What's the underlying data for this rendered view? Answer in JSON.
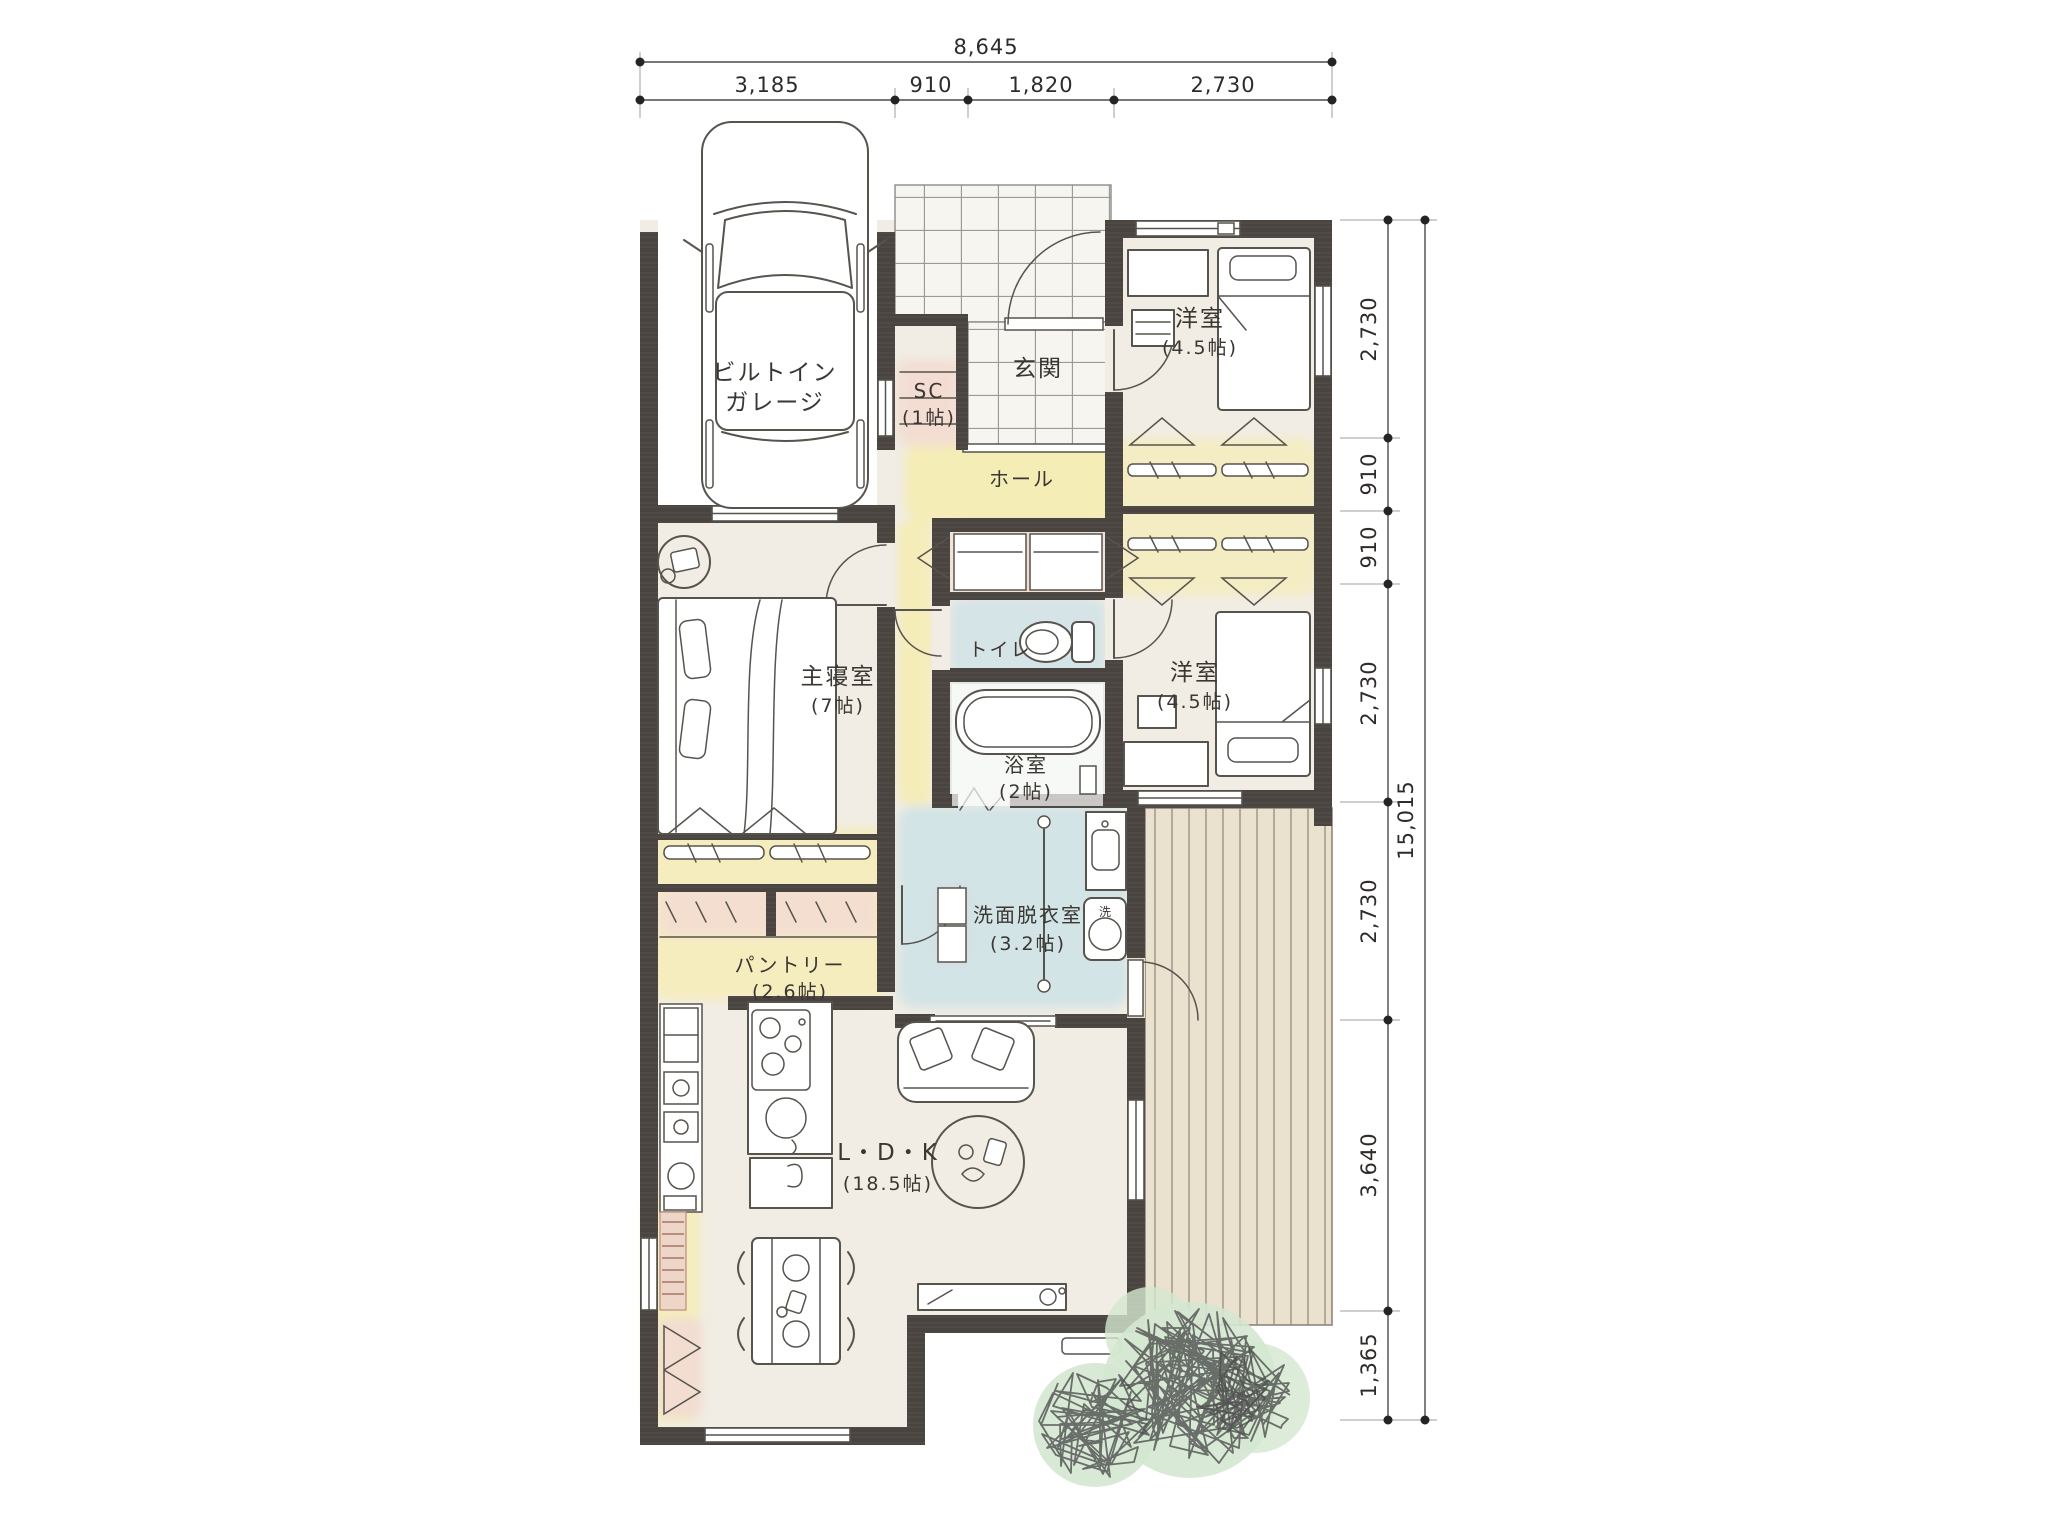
{
  "plan": {
    "dims_top": {
      "total": "8,645",
      "segments": [
        "3,185",
        "910",
        "1,820",
        "2,730"
      ]
    },
    "dims_right": {
      "total": "15,015",
      "segments": [
        "2,730",
        "910",
        "910",
        "2,730",
        "2,730",
        "3,640",
        "1,365"
      ]
    },
    "rooms": {
      "garage": {
        "line1": "ビルトイン",
        "line2": "ガレージ"
      },
      "shoe_closet": {
        "name": "SC",
        "size": "(1帖)"
      },
      "entrance": {
        "name": "玄関"
      },
      "hall": {
        "name": "ホール"
      },
      "bedroom_north": {
        "name": "洋室",
        "size": "(4.5帖)"
      },
      "toilet": {
        "name": "トイレ"
      },
      "bath": {
        "name": "浴室",
        "size": "(2帖)"
      },
      "bedroom_south": {
        "name": "洋室",
        "size": "(4.5帖)"
      },
      "main_bedroom": {
        "name": "主寝室",
        "size": "(7帖)"
      },
      "washroom": {
        "name": "洗面脱衣室",
        "size": "(3.2帖)"
      },
      "pantry": {
        "name": "パントリー",
        "size": "(2.6帖)"
      },
      "ldk": {
        "name": "L・D・K",
        "size": "(18.5帖)"
      }
    },
    "marks": {
      "washer": "洗"
    },
    "colors": {
      "wall": "#4a4441",
      "accent_yellow": "#f6ecae",
      "accent_pink": "#f2dcd1",
      "accent_blue": "#bedde7",
      "deck": "#eae1cf",
      "tree": "#d4e7d0"
    }
  }
}
